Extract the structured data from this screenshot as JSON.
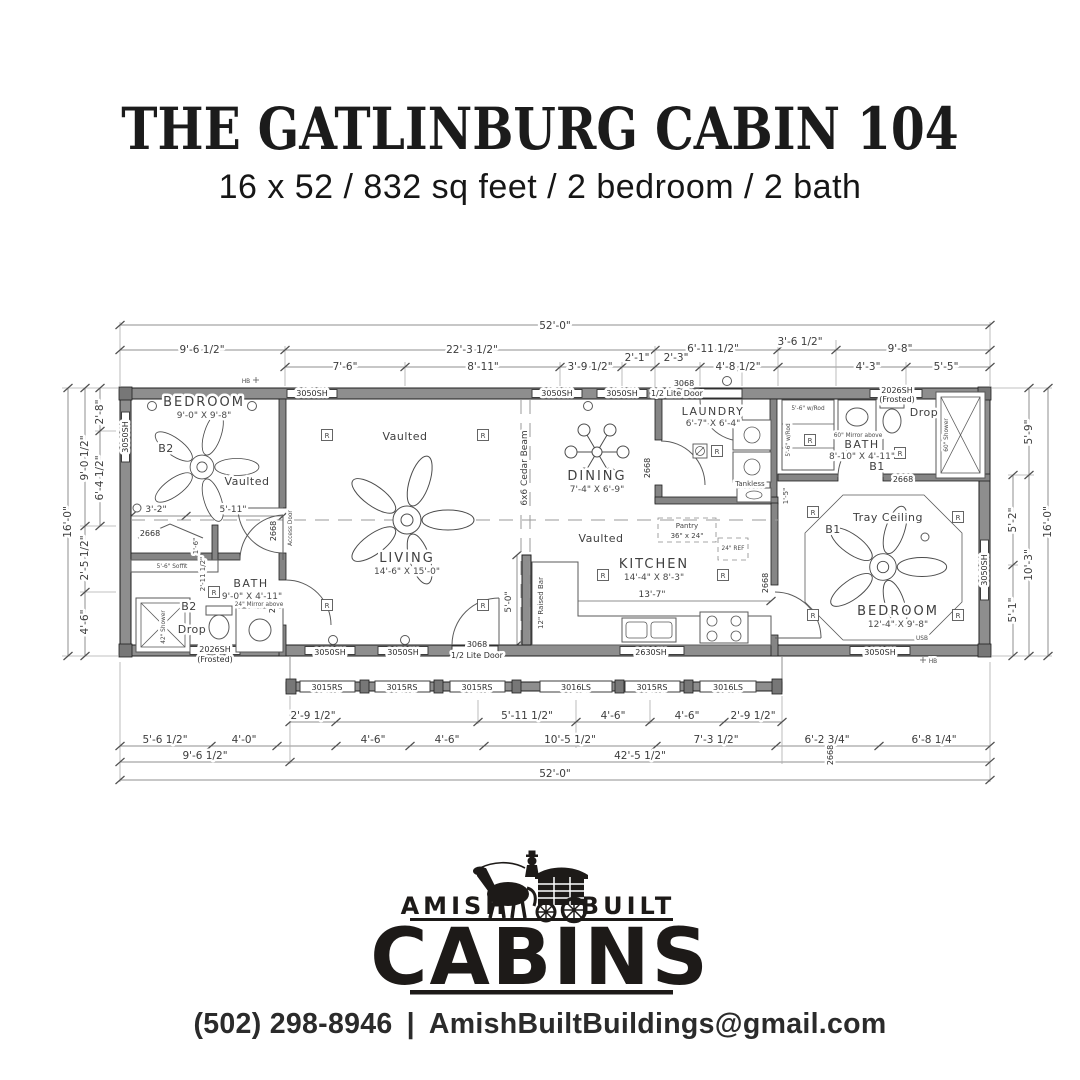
{
  "header": {
    "title": "THE GATLINBURG CABIN 104",
    "subtitle": "16 x 52 / 832 sq feet / 2 bedroom / 2 bath"
  },
  "plan": {
    "dims": {
      "top1": "52'-0\"",
      "top2": [
        "9'-6 1/2\"",
        "22'-3 1/2\"",
        "6'-11 1/2\"",
        "3'-6 1/2\"",
        "9'-8\""
      ],
      "top3": [
        "7'-6\"",
        "8'-11\"",
        "3'-9 1/2\"",
        "2'-1\"",
        "2'-3\"",
        "4'-8 1/2\"",
        "4'-3\"",
        "5'-5\""
      ],
      "left": [
        "2'-8\"",
        "6'-4 1/2\"",
        "9'-0 1/2\"",
        "2'-5 1/2\"",
        "4'-6\"",
        "16'-0\""
      ],
      "right": [
        "5'-9\"",
        "5'-2\"",
        "5'-1\"",
        "10'-3\"",
        "16'-0\""
      ],
      "bottomA": [
        "2'-9 1/2\"",
        "5'-11 1/2\"",
        "4'-6\"",
        "4'-6\"",
        "2'-9 1/2\""
      ],
      "bottomB": [
        "5'-6 1/2\"",
        "4'-0\"",
        "4'-6\"",
        "4'-6\"",
        "10'-5 1/2\"",
        "7'-3 1/2\"",
        "6'-2 3/4\"",
        "6'-8 1/4\""
      ],
      "bottomC": [
        "9'-6 1/2\"",
        "42'-5 1/2\""
      ],
      "bottom1": "52'-0\""
    },
    "inner": {
      "bed2_a": "3'-2\"",
      "bed2_b": "5'-11\"",
      "kitchen_w": "13'-7\"",
      "bar_h": "5'-0\"",
      "bath2_a": "1'-6\"",
      "bath2_b": "2'-11 1/2\"",
      "laundry_s": "1'-5\""
    },
    "rooms": {
      "bedroom2": {
        "name": "BEDROOM",
        "size": "9'-0\" X 9'-8\"",
        "tag": "B2",
        "ceiling": "Vaulted"
      },
      "living": {
        "name": "LIVING",
        "size": "14'-6\" X 15'-0\"",
        "ceiling": "Vaulted"
      },
      "dining": {
        "name": "DINING",
        "size": "7'-4\" X 6'-9\""
      },
      "laundry": {
        "name": "LAUNDRY",
        "size": "6'-7\" X 6'-4\""
      },
      "kitchen": {
        "name": "KITCHEN",
        "size": "14'-4\" X 8'-3\"",
        "ceiling": "Vaulted"
      },
      "bath2": {
        "name": "BATH",
        "size": "9'-0\" X 4'-11\"",
        "tag": "B2",
        "drop": "Drop",
        "mirror": "24\" Mirror above",
        "shower": "42\" Shower",
        "soffit": "5'-6\" Soffit"
      },
      "bath1": {
        "name": "BATH",
        "size": "8'-10\" X 4'-11\"",
        "tag": "B1",
        "drop": "Drop",
        "mirror": "60\" Mirror above",
        "shower": "60\" Shower",
        "closet": "5'-6\" w/Rod"
      },
      "bedroom1": {
        "name": "BEDROOM",
        "size": "12'-4\" X 9'-8\"",
        "tag": "B1",
        "ceiling": "Tray Ceiling"
      }
    },
    "labels": {
      "cedar_beam": "6x6 Cedar Beam",
      "raised_bar": "12\" Raised Bar",
      "pantry": "Pantry",
      "pantry_size": "36\" x 24\"",
      "fridge": "24\" REF",
      "tankless": "Tankless",
      "access_door": "Access Door",
      "recessed": "R",
      "hose_bib": "HB",
      "usb": "USB"
    },
    "openings": {
      "sh3050": "3050SH",
      "sh2026": "2026SH",
      "frosted": "(Frosted)",
      "sh2630": "2630SH",
      "rs3015": "3015RS",
      "ls3016": "3016LS",
      "door3068": "3068",
      "door3068_type": "1/2 Lite Door",
      "door2668": "2668"
    }
  },
  "logo": {
    "amish": "AMISH",
    "built": "BUILT",
    "cabins": "CABINS"
  },
  "footer": {
    "phone": "(502) 298-8946",
    "separator": "|",
    "email": "AmishBuiltBuildings@gmail.com"
  }
}
